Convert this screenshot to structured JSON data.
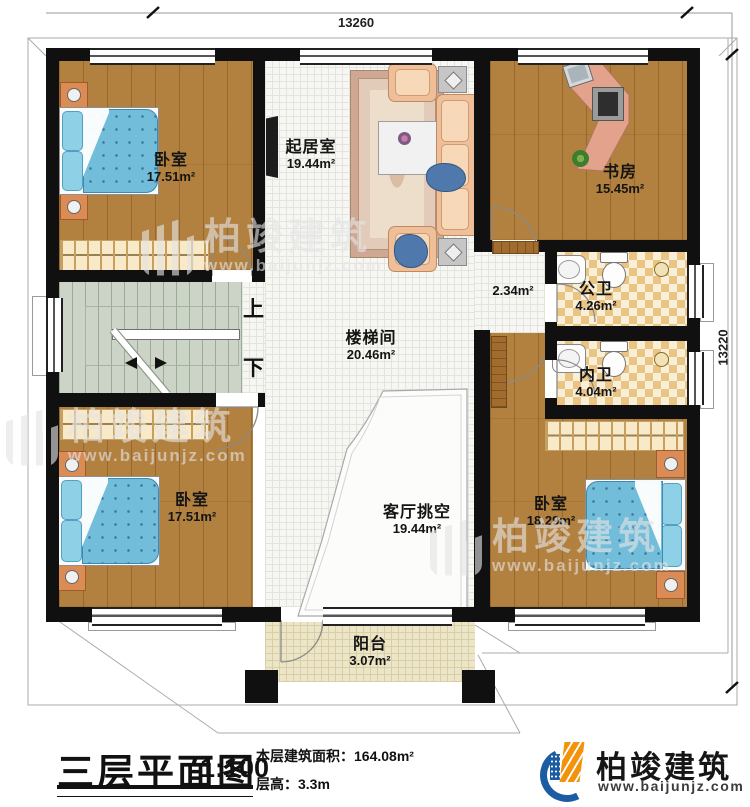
{
  "dimensions": {
    "top": "13260",
    "right": "13220"
  },
  "rooms": {
    "bedroom_tl": {
      "name": "卧室",
      "area": "17.51m²"
    },
    "living": {
      "name": "起居室",
      "area": "19.44m²"
    },
    "study": {
      "name": "书房",
      "area": "15.45m²"
    },
    "corridor": {
      "area": "2.34m²"
    },
    "public_bath": {
      "name": "公卫",
      "area": "4.26m²"
    },
    "inner_bath": {
      "name": "内卫",
      "area": "4.04m²"
    },
    "stairwell": {
      "name": "楼梯间",
      "area": "20.46m²"
    },
    "void": {
      "name": "客厅挑空",
      "area": "19.44m²"
    },
    "bedroom_bl": {
      "name": "卧室",
      "area": "17.51m²"
    },
    "bedroom_br": {
      "name": "卧室",
      "area": "18.29m²"
    },
    "balcony": {
      "name": "阳台",
      "area": "3.07m²"
    }
  },
  "stairs": {
    "up": "上",
    "down": "下"
  },
  "watermark": {
    "brand": "柏竣建筑",
    "url": "www.baijunjz.com"
  },
  "title_block": {
    "title": "三层平面图",
    "scale": "1:100",
    "area_label": "本层建筑面积：",
    "area_value": "164.08m²",
    "height_label": "层高：",
    "height_value": "3.3m"
  },
  "logo": {
    "brand": "柏竣建筑",
    "url": "www.baijunjz.com"
  },
  "colors": {
    "wall": "#101010",
    "wood": "#b2813f",
    "bed": "#72bdd9",
    "logo_blue": "#1b5ca3",
    "logo_orange": "#f2930b"
  }
}
